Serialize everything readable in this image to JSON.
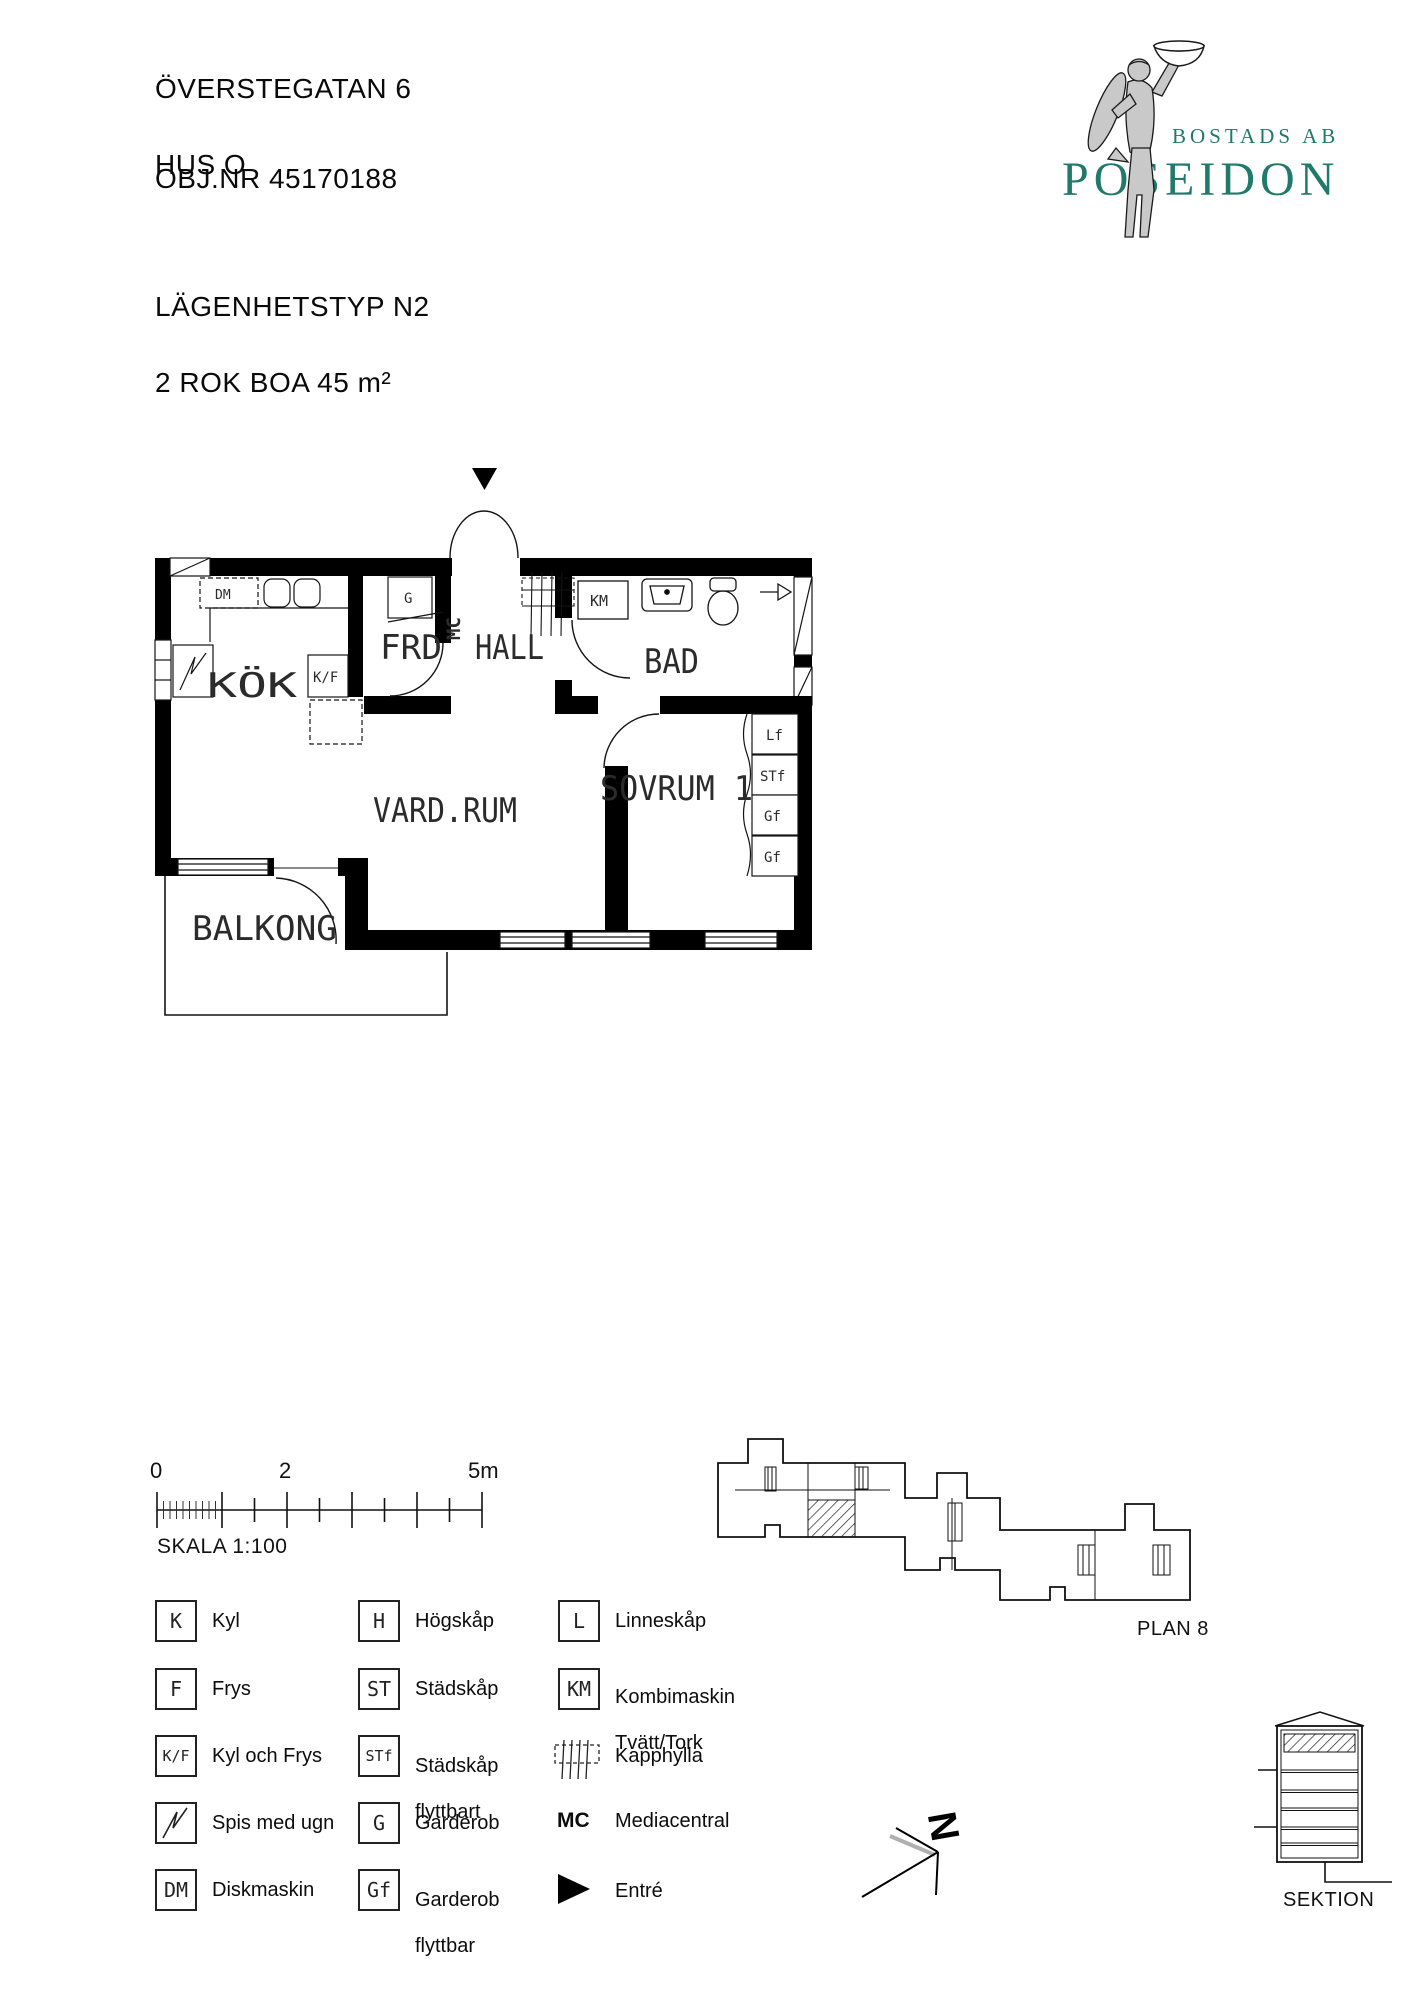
{
  "header": {
    "address_line1": "ÖVERSTEGATAN 6",
    "address_line2": "HUS O",
    "object_number": "OBJ.NR 45170188",
    "apartment_type": "LÄGENHETSTYP N2",
    "size_line": "2 ROK BOA 45 m²"
  },
  "logo": {
    "company_prefix": "BOSTADS AB",
    "company_name": "POSEIDON",
    "brand_color": "#1f7a6b"
  },
  "floor_plan": {
    "rooms": {
      "kitchen": "KÖK",
      "storage": "FRD",
      "hall": "HALL",
      "bath": "BAD",
      "living": "VARD.RUM",
      "bedroom": "SOVRUM 1",
      "balcony": "BALKONG"
    },
    "fixtures": {
      "dm": "DM",
      "kf": "K/F",
      "g": "G",
      "mc": "MC",
      "km": "KM",
      "lf": "Lf",
      "stf": "STf",
      "gf_a": "Gf",
      "gf_b": "Gf"
    }
  },
  "scale_bar": {
    "tick_labels": [
      "0",
      "2",
      "5m"
    ],
    "scale_text": "SKALA 1:100"
  },
  "legend": {
    "col1": [
      {
        "symbol": "K",
        "label": "Kyl"
      },
      {
        "symbol": "F",
        "label": "Frys"
      },
      {
        "symbol": "K/F",
        "label": "Kyl och Frys"
      },
      {
        "symbol": "",
        "label": "Spis med ugn"
      },
      {
        "symbol": "DM",
        "label": "Diskmaskin"
      }
    ],
    "col2": [
      {
        "symbol": "H",
        "label": "Högskåp"
      },
      {
        "symbol": "ST",
        "label": "Städskåp"
      },
      {
        "symbol": "STf",
        "label": "Städskåp",
        "label2": "flyttbart"
      },
      {
        "symbol": "G",
        "label": "Garderob"
      },
      {
        "symbol": "Gf",
        "label": "Garderob",
        "label2": "flyttbar"
      }
    ],
    "col3": [
      {
        "symbol": "L",
        "label": "Linneskåp"
      },
      {
        "symbol": "KM",
        "label": "Kombimaskin",
        "label2": "Tvätt/Tork"
      },
      {
        "symbol": "",
        "label": "Kapphylla"
      },
      {
        "symbol": "MC",
        "label": "Mediacentral"
      },
      {
        "symbol": "",
        "label": "Entré"
      }
    ]
  },
  "site_plan": {
    "label": "PLAN 8"
  },
  "section": {
    "label": "SEKTION"
  },
  "compass": {
    "north_label": "N"
  }
}
